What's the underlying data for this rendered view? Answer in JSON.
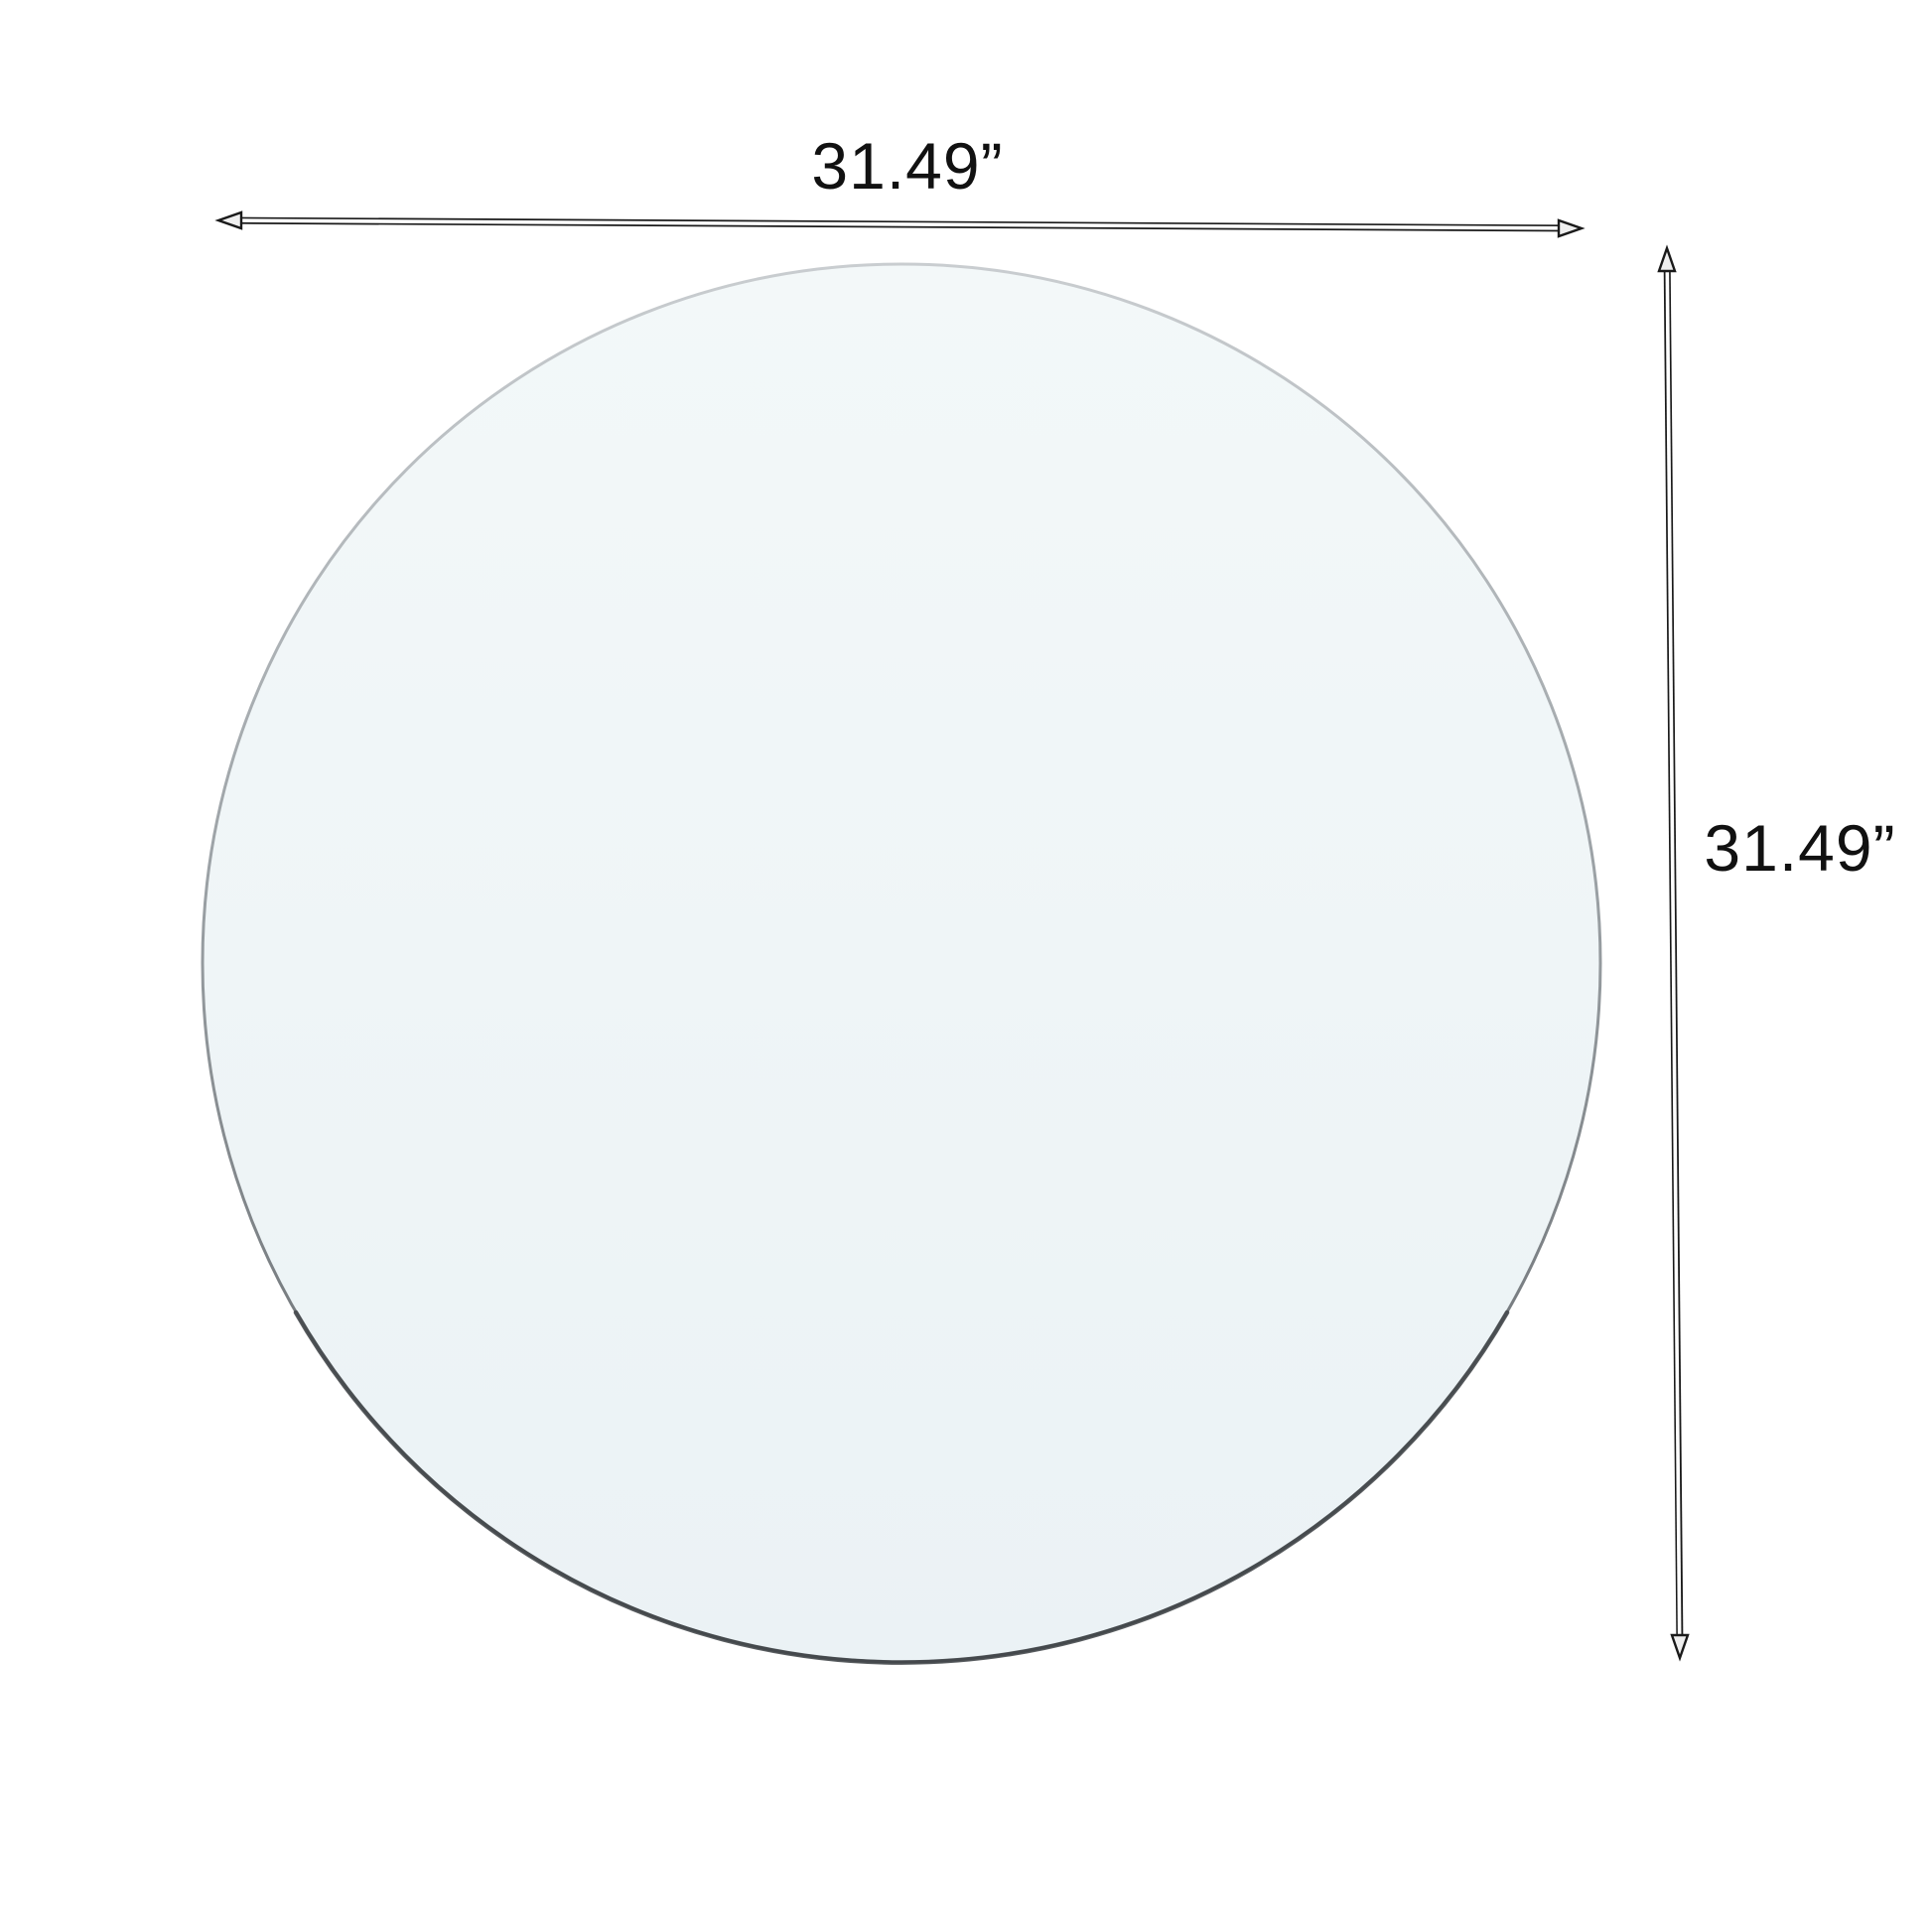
{
  "diagram": {
    "subject": "round-glass-tabletop",
    "labels": {
      "width": "31.49”",
      "height": "31.49”"
    }
  },
  "colors": {
    "background": "#ffffff",
    "glass_fill_top": "#f3f8f9",
    "glass_fill_bottom": "#ebf2f5",
    "glass_edge_top": "#c9cdd0",
    "glass_edge_mid": "#9aa0a4",
    "glass_edge_bottom": "#3e4245",
    "glass_bottom_accent": "#45494c",
    "line_outline": "#1a1a1a",
    "shaft_inner": "#ffffff",
    "arrowhead_fill": "#efefef",
    "text": "#111111"
  }
}
